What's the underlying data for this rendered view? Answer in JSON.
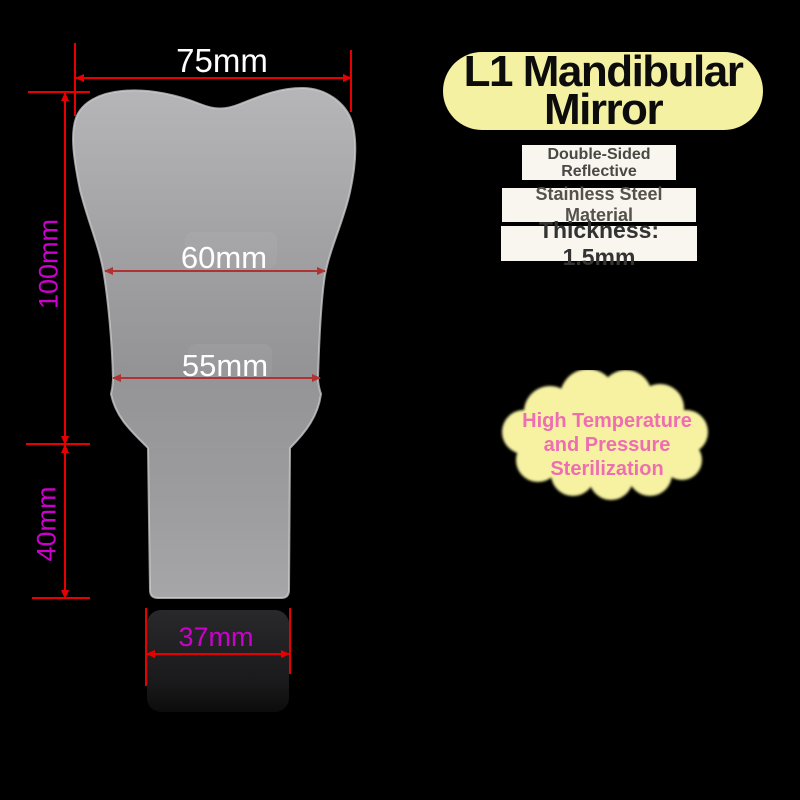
{
  "product": {
    "title_line1": "L1 Mandibular",
    "title_line2": "Mirror",
    "badges": {
      "double_sided_line1": "Double-Sided",
      "double_sided_line2": "Reflective",
      "material": "Stainless Steel Material",
      "thickness": "Thickness: 1.5mm"
    },
    "cloud_line1": "High Temperature",
    "cloud_line2": "and Pressure",
    "cloud_line3": "Sterilization"
  },
  "dimensions": {
    "top_width": "75mm",
    "blade_height": "100mm",
    "upper_width": "60mm",
    "lower_width": "55mm",
    "neck_height": "40mm",
    "handle_width": "37mm"
  },
  "colors": {
    "background": "#000000",
    "dimension_red": "#e80000",
    "dimension_red_on_mirror": "#b03232",
    "dimension_magenta": "#cc00cc",
    "label_white": "#ffffff",
    "title_pill_yellow": "#f5f1a2",
    "title_text": "#0c0c0c",
    "cloud_yellow": "#f6f2a2",
    "cloud_pink": "#ee6eb2",
    "badge_background": "#f8f6ef",
    "mirror_gray": "#9a9a9c",
    "handle_base_black": "#1b1b1d"
  }
}
